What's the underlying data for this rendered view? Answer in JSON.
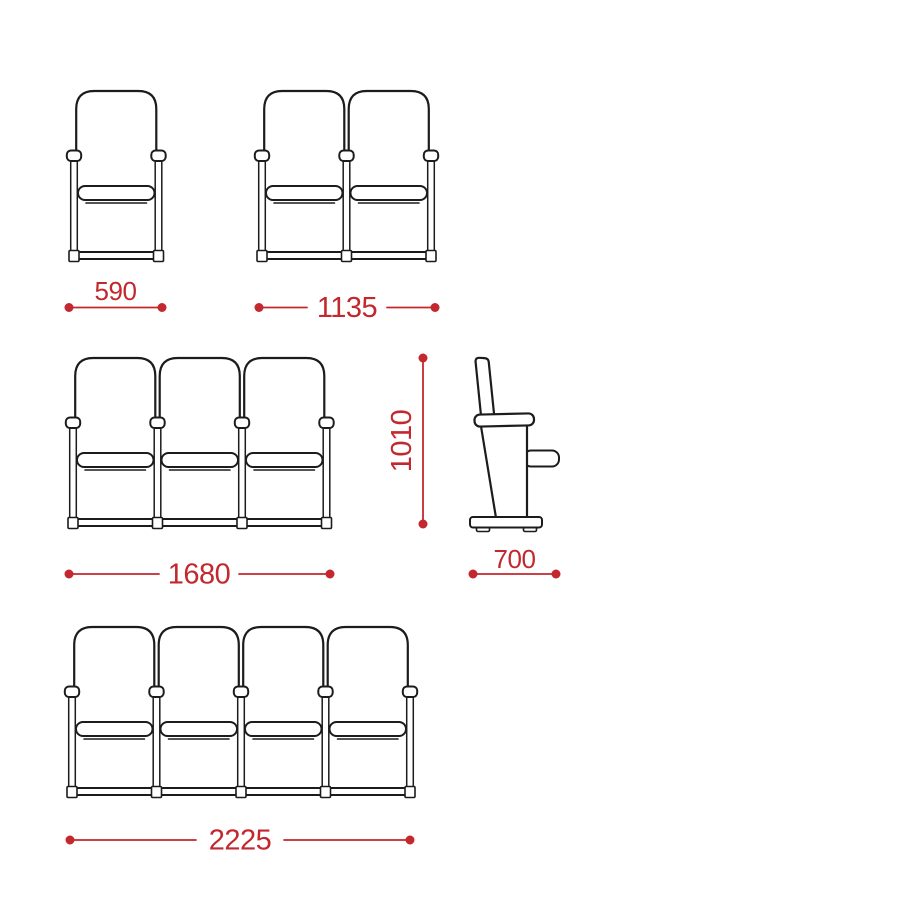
{
  "drawing": {
    "type": "seating dimension diagram",
    "background_color": "#ffffff",
    "accent_color": "#c2282d",
    "line_color": "#1c1c1c",
    "views": {
      "single_front": {
        "name": "1-seat row front view",
        "seats": 1,
        "width_dimension": "590"
      },
      "double_front": {
        "name": "2-seat row front view",
        "seats": 2,
        "width_dimension": "1135"
      },
      "triple_front": {
        "name": "3-seat row front view",
        "seats": 3,
        "width_dimension": "1680"
      },
      "side": {
        "name": "side view",
        "height_dimension": "1010",
        "depth_dimension": "700"
      },
      "quad_front": {
        "name": "4-seat row front view",
        "seats": 4,
        "width_dimension": "2225"
      }
    }
  }
}
